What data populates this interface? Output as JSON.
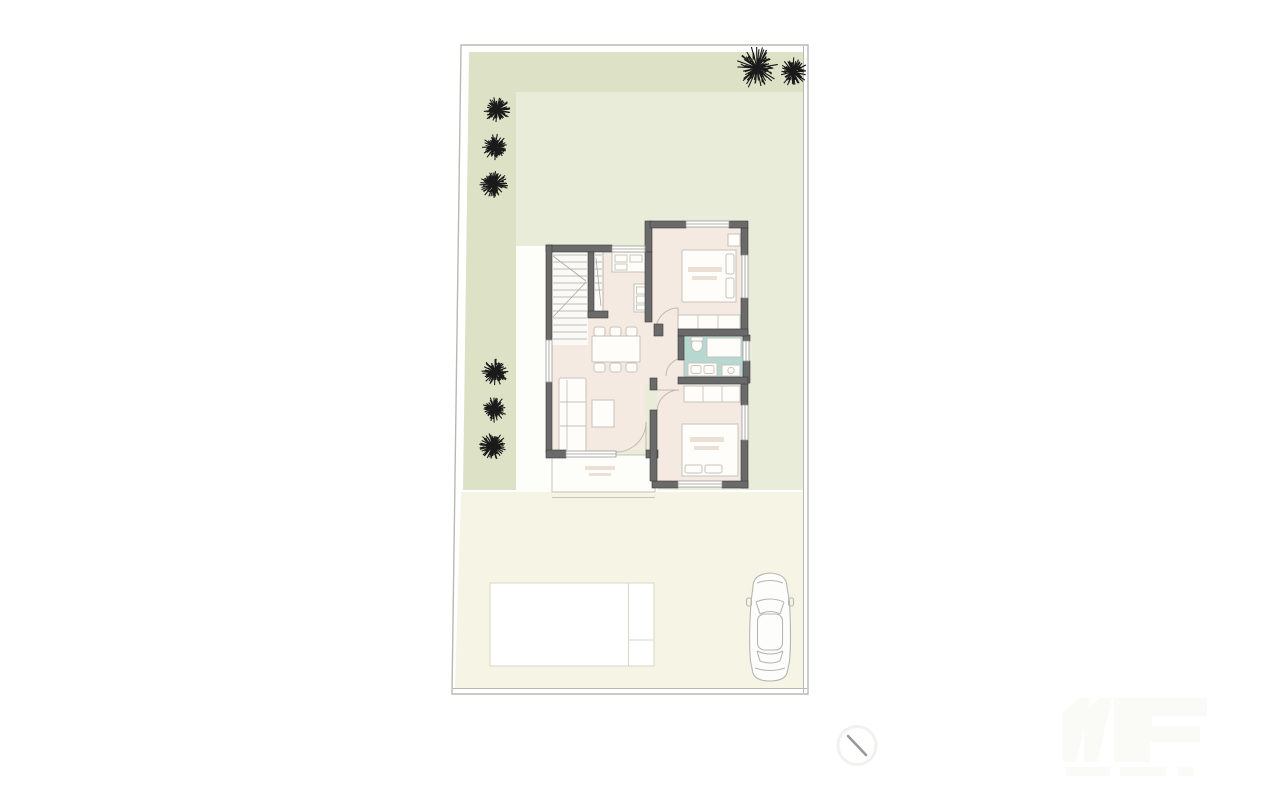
{
  "document": {
    "kind": "residential-site-and-ground-floor-plan",
    "visible_text": [],
    "watermark": {
      "present": true,
      "legible": false,
      "position": "bottom-right"
    }
  },
  "colors": {
    "page": "#ffffff",
    "boundary": "#b8b8b4",
    "sage": "#dde2c6",
    "lawn": "#e9ecd8",
    "courtyard": "#fdfdfa",
    "paving": "#f6f4e4",
    "room": "#f4eae1",
    "wet_room": "#b6d8d1",
    "wall": "#6a6a6a",
    "wall_edge": "#3a3a3a",
    "thin": "#9a9a96",
    "furn_line": "#c6c3ba",
    "furn_fill": "#fffdf9",
    "stair_line": "#a9a8a2",
    "door": "#c2bab0",
    "pool_line": "#d9d7c6",
    "car_line": "#b6b6b4",
    "tree": "#1a1a1a",
    "smudge": "#eae0d6",
    "watermark": "#fafaf7",
    "mark": "#999999"
  },
  "site": {
    "boundary_outer": "461,45 808,45 808,694 452,694",
    "fence_inner_right_x": 803.5,
    "fence_inner_bottom_y": 688.5,
    "garden_sage_poly": "469,52 803,52 803,490 463,490",
    "lawn_rect": {
      "x": 516,
      "y": 92,
      "w": 287,
      "h": 398
    },
    "courtyard_poly": "516,246 546,246 546,455 658,455 658,492 516,492",
    "driveway_poly": "461,492 803,492 803,688 455,688",
    "trees": [
      {
        "x": 757,
        "y": 68,
        "r": 21
      },
      {
        "x": 793,
        "y": 72,
        "r": 14
      },
      {
        "x": 497,
        "y": 110,
        "r": 13
      },
      {
        "x": 495,
        "y": 147,
        "r": 13
      },
      {
        "x": 494,
        "y": 184,
        "r": 14
      },
      {
        "x": 495,
        "y": 372,
        "r": 13
      },
      {
        "x": 494,
        "y": 409,
        "r": 13
      },
      {
        "x": 493,
        "y": 446,
        "r": 14
      }
    ],
    "pool": {
      "x": 490,
      "y": 583,
      "w": 164,
      "h": 83,
      "divider_x": 628.5,
      "step_line_y": 640
    },
    "car": {
      "x": 748,
      "y": 572,
      "w": 44,
      "h": 110
    }
  },
  "house": {
    "rooms": [
      {
        "id": "staircase"
      },
      {
        "id": "kitchen"
      },
      {
        "id": "bedroom-1"
      },
      {
        "id": "bathroom"
      },
      {
        "id": "living-dining"
      },
      {
        "id": "bedroom-2"
      },
      {
        "id": "terrace"
      }
    ]
  },
  "annotation_mark": {
    "x1": 848,
    "y1": 736,
    "x2": 866,
    "y2": 755,
    "circle_r": 19
  }
}
